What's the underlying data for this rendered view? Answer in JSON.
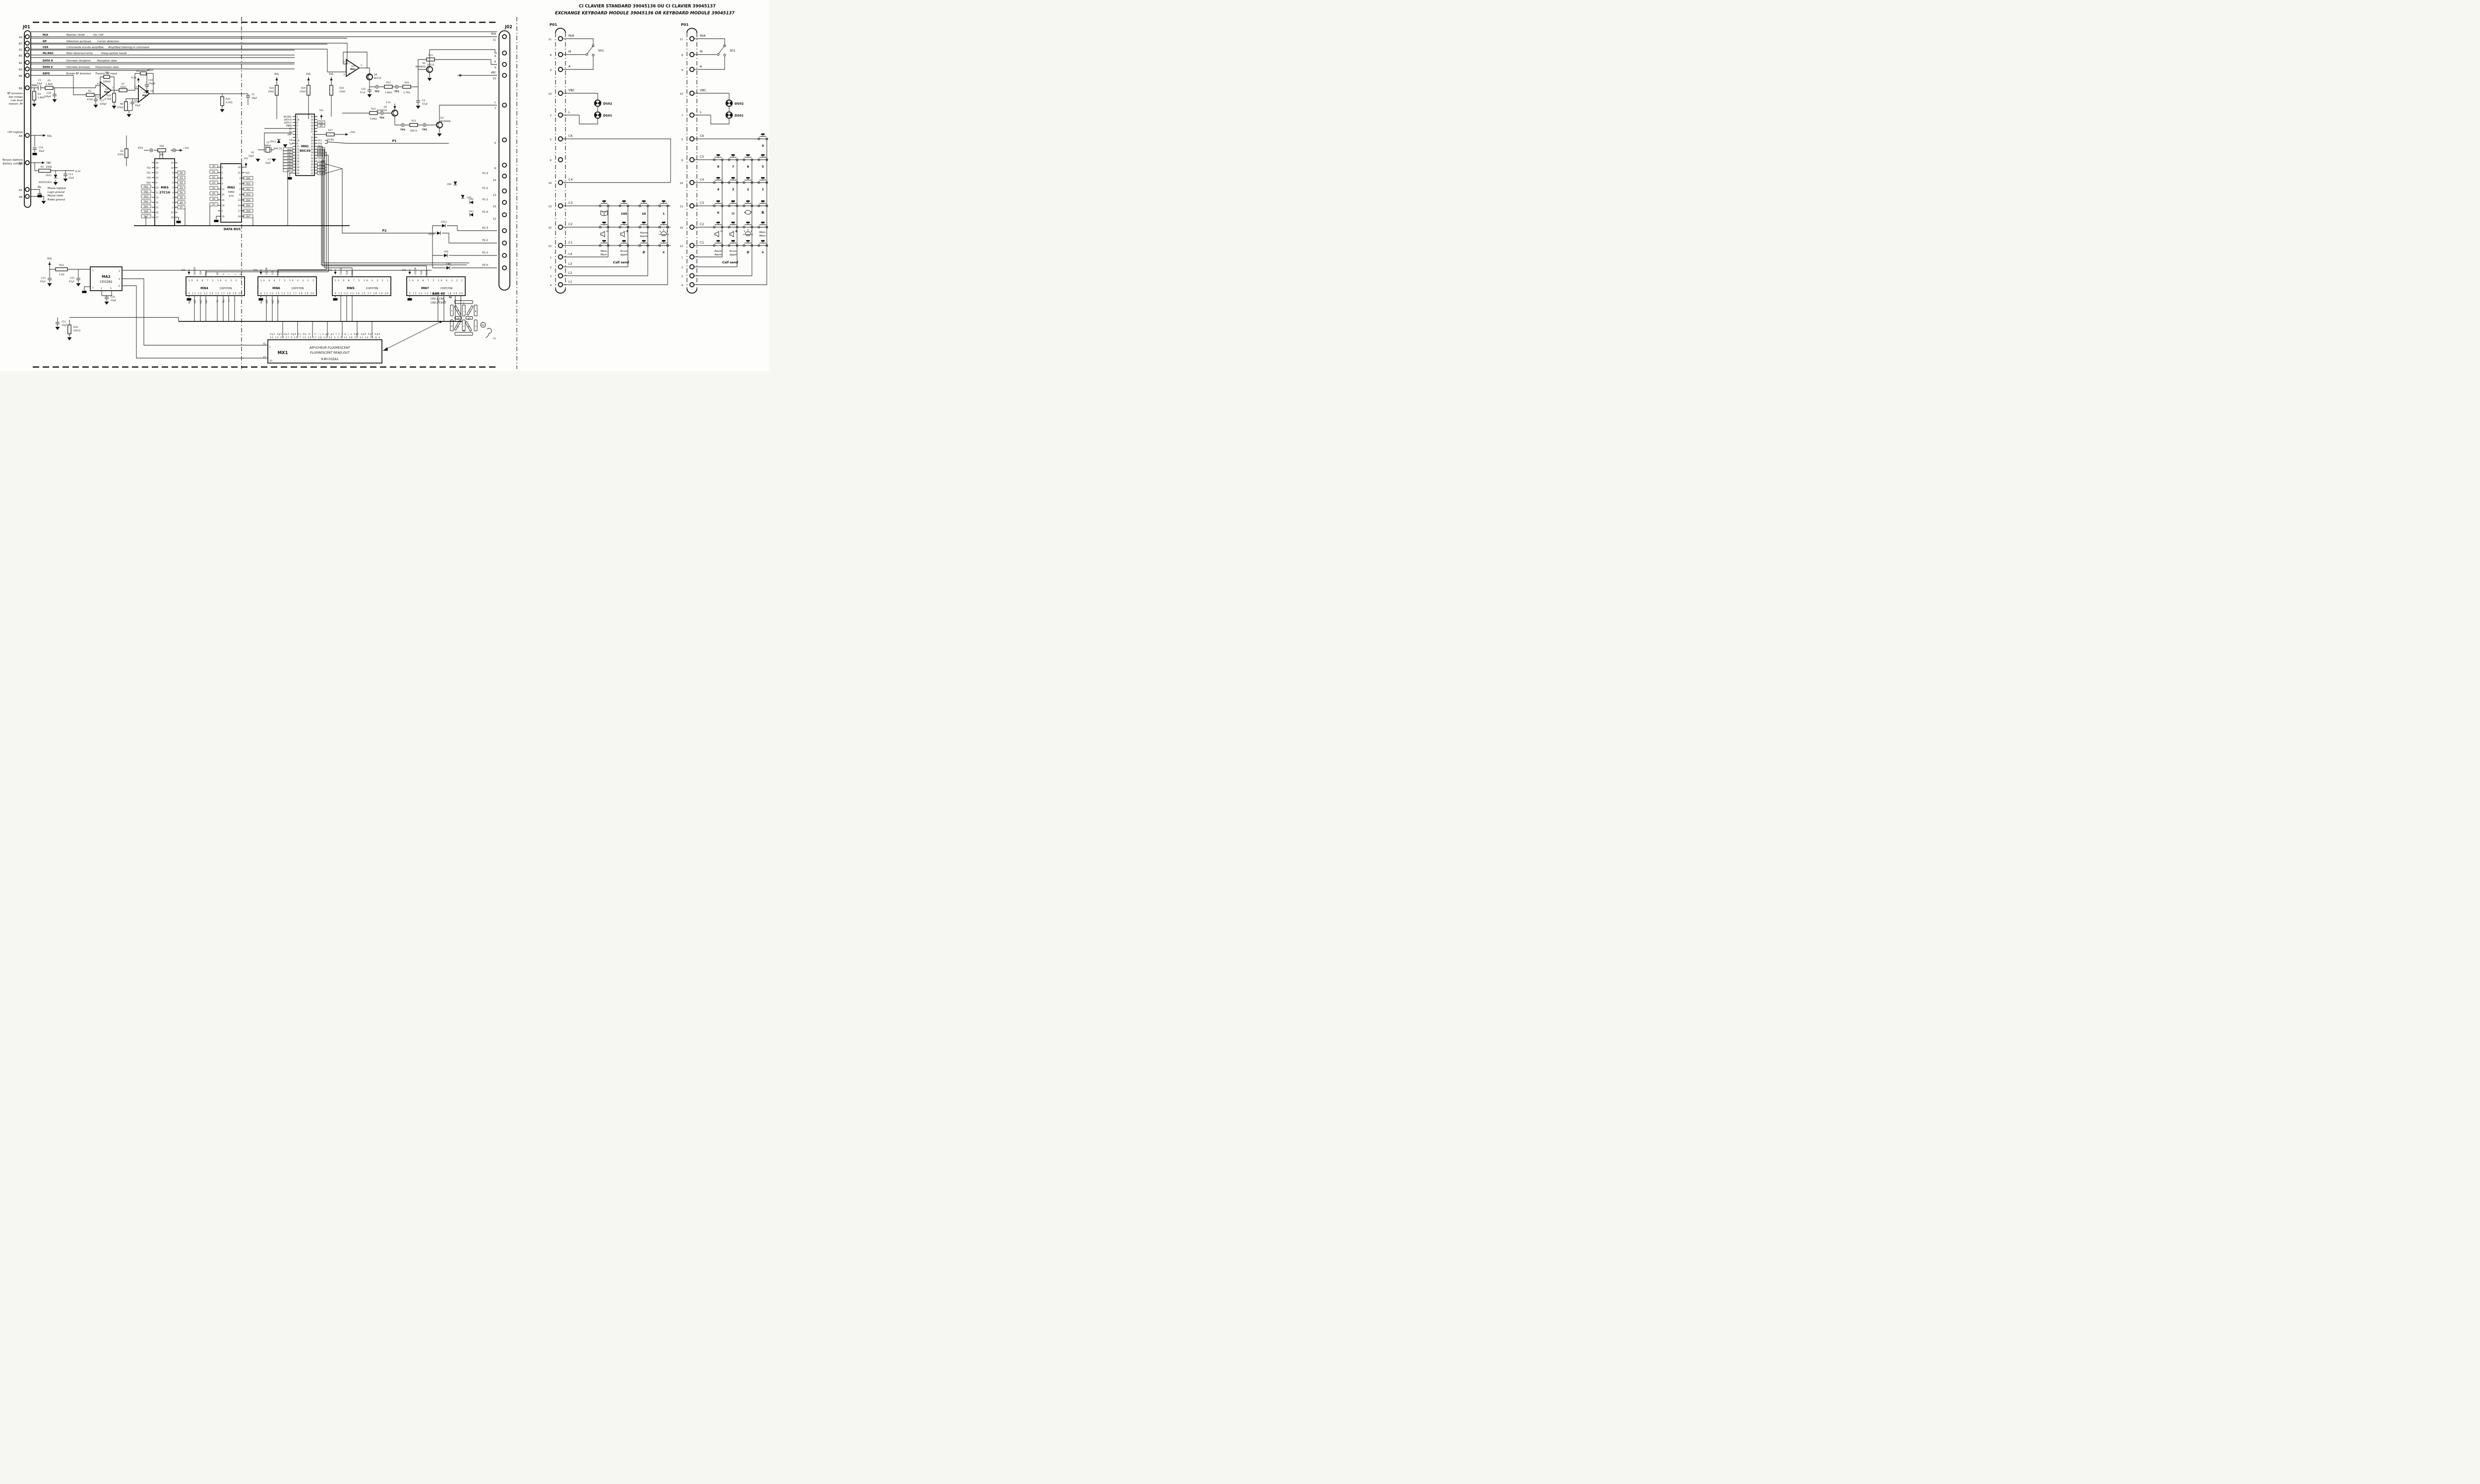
{
  "titles": {
    "fr": "CI CLAVIER STANDARD 39045136    OU    CI CLAVIER 39045137",
    "en": "EXCHANGE KEYBOARD MODULE 39045136  OR  KEYBOARD MODULE 39045137"
  },
  "j01": {
    "name": "J01",
    "rows": [
      {
        "pin": "A3",
        "abbr": "M/A",
        "fr": "Marche / Arrêt",
        "en": "On / Off"
      },
      {
        "pin": "B7",
        "abbr": "DP",
        "fr": "Détection porteuse",
        "en": "Carrier detection"
      },
      {
        "pin": "A1",
        "abbr": "CEA",
        "fr": "Commande écoute amplifiée",
        "en": "Amplified listening-in command"
      },
      {
        "pin": "B2",
        "abbr": "ML/RAC",
        "fr": "Main libre/raccroché",
        "en": "Hang-up/free hands"
      },
      {
        "pin": "B1",
        "abbr": "DATA R",
        "fr": "Données réception",
        "en": "Reception data"
      },
      {
        "pin": "B3",
        "abbr": "DATA E",
        "fr": "Données émission",
        "en": "Transmission data"
      },
      {
        "pin": "B5",
        "abbr": "EBFE",
        "fr": "Entrée BF émission",
        "en": "Transm. AF input"
      }
    ],
    "b6": {
      "pin": "B6",
      "net": "EBN",
      "l1": "BF émission",
      "l2": "bas niveau",
      "l3": "Low level",
      "l4": "transm. AF"
    },
    "a4": {
      "pin": "A4",
      "l": "+5V logique",
      "net": "5VL"
    },
    "b4": {
      "pin": "B4",
      "l1": "Tension batterie",
      "l2": "Battery voltage",
      "net": "VBC"
    },
    "a2": {
      "pin": "A2",
      "net": "ML",
      "l1": "Masse logique",
      "l2": "Logic ground"
    },
    "a6": {
      "pin": "A6",
      "net": "MR",
      "l1": "Masse radio",
      "l2": "Radio ground"
    }
  },
  "analog": {
    "c1": "C1",
    "c1v": "10µF",
    "r5": "R5",
    "r5v": "1,8kΩ",
    "r4": "R4",
    "r4v": "1,8kΩ",
    "c16": "C16",
    "c16v": "100pF",
    "r3": "R3",
    "r3v": "47kΩ",
    "r6": "R6",
    "r6v": "100kΩ",
    "c17": "C17",
    "c17v": "100pF",
    "r32": "R32",
    "r32v": "4,7kΩ",
    "r7": "R7",
    "r7v": "33kΩ",
    "r9": "R9",
    "r9v": "68kΩ",
    "c18": "C18",
    "c18v": "100pF",
    "v82": "8,2V",
    "r8": "R8",
    "r8v": "47kΩ",
    "c4": "C4",
    "c4v": "10µF",
    "r33": "R33",
    "r33v": "4,7kΩ",
    "c5": "C5",
    "c5v": "10µF",
    "r2": "R2",
    "r2v": "47kΩ",
    "c14": "C14",
    "c14v": "10µF",
    "r1": "R1",
    "r1v": "100Ω",
    "cr12": "CR12",
    "cr12v": "BZX55C8V2",
    "c13": "C13",
    "c13v": "10µF",
    "oa": "1/4",
    "ma1": "MA1",
    "minus": "−",
    "plus": "+",
    "p6": "6",
    "p5": "5",
    "p7": "7",
    "p13": "13",
    "p12": "12",
    "p14": "14",
    "p2": "2",
    "p3": "3",
    "p1": "1",
    "vl": "5VL",
    "vl2": "5 VL",
    "vlp": "+5VL",
    "vbc": "VBC",
    "r34": "R34",
    "r34v": "10kΩ",
    "r29": "R29",
    "r29v": "22kΩ",
    "r30": "R30",
    "r30v": "22kΩ",
    "r42": "R42",
    "r42v": "220 Ω",
    "q4": "Q4",
    "q4v": "BCF32",
    "q1": "Q1",
    "q1v": "BCW60D",
    "r12": "R12",
    "r12v": "1,8kΩ",
    "r10": "R10",
    "r10v": "2,7kΩ",
    "c20": "C20",
    "c20v": "47uF",
    "c9": "C9",
    "c9v": "47µF",
    "r11": "R11",
    "r11v": "100 Ω",
    "r31": "R31",
    "r31v": "6,8kΩ",
    "q2": "Q2",
    "q2v": "BCW61D",
    "r13": "R13",
    "r13v": "680 Ω",
    "q3": "Q3",
    "q3v": "BCW60D",
    "r37": "R37",
    "r37v": "10 KΩ",
    "tp1": "TP1",
    "tp2": "TP2",
    "tp3": "TP3",
    "tp4": "TP4",
    "tp5": "TP5"
  },
  "mn1": {
    "name": "MN1",
    "part": "80C39",
    "lnum": [
      "1",
      "38",
      "6",
      "9",
      "2",
      "3",
      "4",
      "5",
      "10",
      "8",
      "11",
      "12",
      "13",
      "14",
      "15",
      "16",
      "17",
      "18",
      "19",
      "20"
    ],
    "llab": [
      "ML/RAC",
      "DATA R",
      "DATA E",
      "PSEN",
      "X1",
      "X2",
      "RST",
      "",
      "",
      "",
      "",
      "Db0",
      "Db1",
      "Db2",
      "Db3",
      "Db4",
      "Db5",
      "Db6",
      "Db7",
      ""
    ],
    "rnum": [
      "40",
      "26",
      "39",
      "36",
      "35",
      "37",
      "7",
      "25",
      "34",
      "33",
      "30",
      "29",
      "28",
      "27",
      "32",
      "31",
      "24",
      "23",
      "22",
      "21"
    ],
    "rlab": [
      "",
      "",
      "CEA",
      "DP",
      "",
      "",
      "",
      "",
      "P17",
      "P16",
      "P13",
      "P12",
      "P11",
      "P10",
      "CLK",
      "CSCOP",
      "P23",
      "P22",
      "P21",
      "P20"
    ]
  },
  "rom": {
    "name": "MN3",
    "part": "27C16",
    "lnum": [
      "20",
      "19",
      "22",
      "23",
      "9",
      "10",
      "11",
      "13",
      "14",
      "15",
      "16",
      "17"
    ],
    "llab": [
      "",
      "P22",
      "P21",
      "P20",
      "Db0",
      "Db1",
      "Db2",
      "Db3",
      "Db4",
      "Db5",
      "Db6",
      "Db7"
    ],
    "rnum": [
      "21",
      "24",
      "8",
      "7",
      "6",
      "5",
      "4",
      "3",
      "2",
      "1",
      "12",
      "18"
    ],
    "rlab": [
      "",
      "",
      "D0",
      "D1",
      "D2",
      "D3",
      "D4",
      "D5",
      "D6",
      "D7",
      "",
      ""
    ],
    "p23": "P23",
    "r36": "R36",
    "r36v": "0Ω",
    "vlp": "+5VL"
  },
  "latch": {
    "name": "MN2",
    "part": "74HC",
    "part2": "373",
    "lnum": [
      "2",
      "5",
      "6",
      "9",
      "12",
      "15",
      "16",
      "19",
      "1",
      "10"
    ],
    "llab": [
      "D0",
      "D1",
      "D2",
      "D3",
      "D4",
      "D5",
      "D6",
      "D7",
      "",
      ""
    ],
    "rnum": [
      "20",
      "11",
      "3",
      "4",
      "7",
      "8",
      "13",
      "14",
      "17",
      "18"
    ],
    "rlab": [
      "",
      "ALE",
      "Db0",
      "Db1",
      "Db2",
      "Db3",
      "Db4",
      "Db5",
      "Db6",
      "Db7"
    ],
    "vl": "5VL",
    "databus": "DATA BUS"
  },
  "xtal": {
    "y1": "Y1",
    "y1v": "6MHz",
    "c6": "C6",
    "c6v": "33pF",
    "c7": "C7",
    "c7v": "33pF",
    "c8": "C8",
    "c8v": "1µF",
    "cr13": "CR13",
    "type": "BAS 16"
  },
  "j02": {
    "name": "J02",
    "p1": "P1",
    "p2": "P2",
    "pins": [
      {
        "l": "M/A",
        "n": "11"
      },
      {
        "l": "",
        "n": "8"
      },
      {
        "l": "A",
        "n": "9"
      },
      {
        "l": "VBC",
        "n": "10"
      },
      {
        "l": "L",
        "n": "7"
      },
      {
        "l": "",
        "n": "5"
      },
      {
        "l": "",
        "n": "6"
      },
      {
        "l": "P1-3",
        "n": "14"
      },
      {
        "l": "P1-2",
        "n": "13"
      },
      {
        "l": "P1-1",
        "n": "15"
      },
      {
        "l": "P1-0",
        "n": "12"
      },
      {
        "l": "P2-3",
        "n": ""
      },
      {
        "l": "P2-2",
        "n": ""
      },
      {
        "l": "P2-1",
        "n": ""
      },
      {
        "l": "P2-0",
        "n": ""
      }
    ],
    "cr": [
      "CR6",
      "CR5",
      "CR4",
      "CR3",
      "CR11",
      "CR10",
      "CR9",
      "CR8"
    ]
  },
  "power": {
    "vl": "5VL",
    "r24": "R24",
    "r24v": "2,2Ω",
    "c15": "C15",
    "c15v": "47µF",
    "c12": "C12",
    "c12v": "47µF",
    "ma2": "MA2",
    "ma2v": "CEO282",
    "p1": "1",
    "p7": "7",
    "p2": "2",
    "p5": "5",
    "p3": "3",
    "p4": "4",
    "p6": "6",
    "c10": "C10",
    "c10v": "10µF",
    "c11": "C11",
    "c11v": "10µF",
    "r43": "R43",
    "r43v": "100 Ω"
  },
  "drv": [
    {
      "name": "MN4",
      "part": "COP370N",
      "vl": "5VL",
      "sel": "GSCOP",
      "clk": "CLK",
      "port": "P10",
      "nc": "NC",
      "tn": "10  9  8  7  5  16  4  3  2  1",
      "bn": "6  11  12  13  14  15  17  18  19  20",
      "tseg": [
        "h",
        "i",
        "j",
        "k"
      ],
      "bseg": [
        "dg1",
        "dg2",
        "dg3",
        "dg4",
        "Co",
        "Dp",
        "m",
        "l"
      ]
    },
    {
      "name": "MN6",
      "part": "COP370N",
      "vl": "5VL",
      "sel": "CSCOP",
      "clk": "CLK",
      "port": "P11",
      "nc": "NC",
      "tn": "10  9  8  7  5  16  4  3  2  1",
      "bn": "6  11  12  13  14  15  17  18  19  20",
      "tseg": [],
      "bseg": [
        "dg1",
        "dg2",
        "dg3",
        "dg4"
      ]
    },
    {
      "name": "MN5",
      "part": "COP370N",
      "vl": "5VL",
      "sel": "CSCOP",
      "clk": "CLK",
      "port": "P12",
      "nc": "NC",
      "tn": "10  9  8  7  5  16  4  3  2  1",
      "bn": "6  11  12  13  14  15  17  18  19  20",
      "tseg": [],
      "bseg": []
    },
    {
      "name": "MN7",
      "part": "COP370N",
      "vl": "5VL",
      "sel": "CSCOP",
      "clk": "CLK",
      "port": "P13",
      "nc": "NC",
      "tn": "10  9  8  7  5  16  4  3  2  1",
      "bn": "6  11  12  13  14  15  17  18  19  20",
      "tseg": [],
      "bseg": [
        "g2",
        "g1",
        "f",
        "e"
      ]
    }
  ],
  "mx1": {
    "name": "MX1",
    "fr": "AFFICHEUR FLUORESCENT",
    "en": "FLUORESCENT READ-OUT",
    "part": "9-BY-03ZA1",
    "f1": "f1",
    "n1": "1",
    "f2": "f2",
    "n2": "33",
    "tn": "26 23 20 17 9 15 7 10 25 27 28 12 24 5 3 6 31 29 22 13 14 11 8 4",
    "tl": "dg1 dg2 dg3 dg4 Co Dp m l h i j k g2 g1 f e d b c a dg5 dg6 dg7 dg8"
  },
  "seg": {
    "bar": "BAR 43",
    "cr1": "CR3 à CR6",
    "cr2": "CR8 à CR11",
    "to": "to",
    "a": "a",
    "b": "b",
    "c": "c",
    "d": "d",
    "e": "e",
    "f": "f",
    "g1": "g1",
    "g2": "g2",
    "h": "h",
    "i": "i",
    "j": "j",
    "k": "k",
    "l": "l",
    "m": "m",
    "dp": "Dp",
    "co": "Co"
  },
  "kb1": {
    "p01": "P01",
    "s01": "S01",
    "ds02": "DS02",
    "ds01": "DS01",
    "pins": [
      {
        "n": "11",
        "l": "M/A"
      },
      {
        "n": "8",
        "l": "M"
      },
      {
        "n": "9",
        "l": "A"
      },
      {
        "n": "10",
        "l": "VBC"
      },
      {
        "n": "7",
        "l": "L"
      },
      {
        "n": "5",
        "l": "C6"
      },
      {
        "n": "6",
        "l": ""
      },
      {
        "n": "14",
        "l": "C4"
      },
      {
        "n": "13",
        "l": "C3"
      },
      {
        "n": "15",
        "l": "C2"
      },
      {
        "n": "12",
        "l": "C1"
      },
      {
        "n": "1",
        "l": "L4"
      },
      {
        "n": "2",
        "l": "L3"
      },
      {
        "n": "3",
        "l": "L2"
      },
      {
        "n": "4",
        "l": "L1"
      }
    ],
    "k100": "100",
    "k10": "10",
    "k1": "1",
    "alarm1": "Alarm",
    "alarm2": "Alarm",
    "mem1": "Mém.",
    "mem2": "Mem.",
    "envoi1": "Envoi",
    "envoi2": "appel",
    "call": "Call send",
    "hash": "#",
    "star": "*"
  },
  "kb2": {
    "p01": "P01",
    "s01": "S01",
    "ds02": "DS02",
    "ds01": "DS01",
    "pins": [
      {
        "n": "11",
        "l": "M/A"
      },
      {
        "n": "8",
        "l": "M"
      },
      {
        "n": "9",
        "l": "A"
      },
      {
        "n": "10",
        "l": "VBC"
      },
      {
        "n": "7",
        "l": "L"
      },
      {
        "n": "5",
        "l": "C6"
      },
      {
        "n": "6",
        "l": "C5"
      },
      {
        "n": "14",
        "l": "C4"
      },
      {
        "n": "13",
        "l": "C3"
      },
      {
        "n": "15",
        "l": "C2"
      },
      {
        "n": "12",
        "l": "C1"
      },
      {
        "n": "1",
        "l": ""
      },
      {
        "n": "2",
        "l": ""
      },
      {
        "n": "3",
        "l": ""
      },
      {
        "n": "4",
        "l": ""
      }
    ],
    "d9": "9",
    "d8": "8",
    "d7": "7",
    "d6": "6",
    "d5": "5",
    "d4": "4",
    "d3": "3",
    "d2": "2",
    "d1": "1",
    "d0": "0",
    "r": "R",
    "env": "✉",
    "alarm1": "Alarm",
    "alarm2": "Alarm",
    "mem1": "Mém.",
    "mem2": "Mem.",
    "envoi1": "Envoi",
    "envoi2": "appel",
    "call": "Call send",
    "hash": "#",
    "star": "*"
  }
}
